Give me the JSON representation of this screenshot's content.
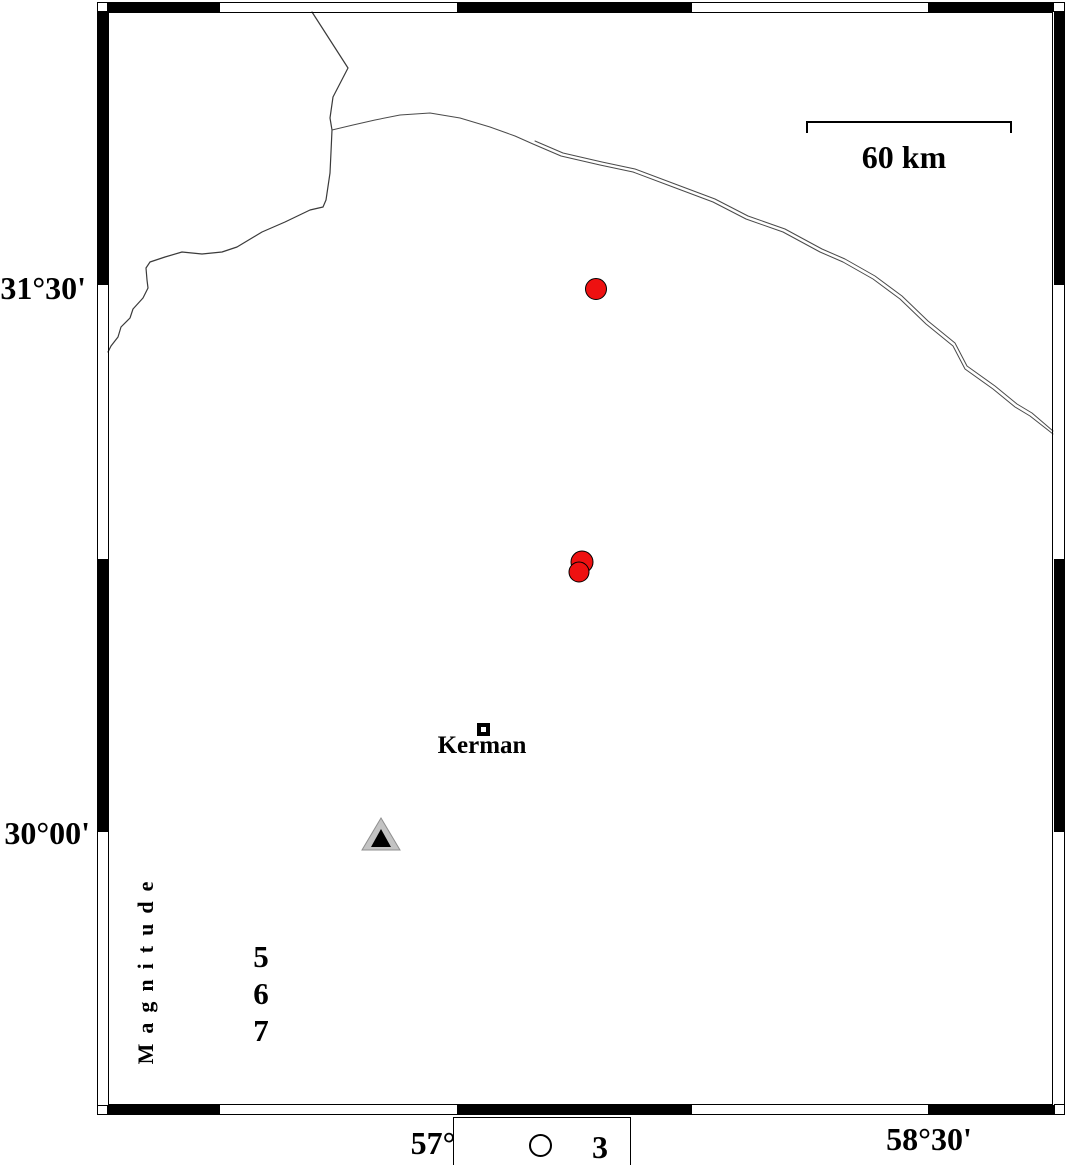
{
  "map": {
    "lat_labels": {
      "upper": "31°30'",
      "lower": "30°00'"
    },
    "lon_labels": {
      "left": "57°",
      "right": "58°30'"
    },
    "scale_bar": {
      "label": "60 km",
      "path": "M 807 133 L 807 122 L 1011 122 L 1011 133"
    },
    "city": {
      "name": "Kerman"
    },
    "magnitude_legend": {
      "title": "Magnitude",
      "values": {
        "v1": "5",
        "v2": "6",
        "v3": "7"
      }
    },
    "symbol_legend": {
      "value": "3"
    },
    "colors": {
      "event_fill": "#ee1111",
      "station_fill": "#c3c3c3",
      "station_core": "#000000",
      "line": "#3a3a3a"
    },
    "events": [
      {
        "cx": 596,
        "cy": 289,
        "r": 10.5
      },
      {
        "cx": 582,
        "cy": 562,
        "r": 11
      },
      {
        "cx": 579,
        "cy": 572,
        "r": 10
      }
    ],
    "shapes": {
      "boundary_line": "312,12 348,68 333,97 330,118 332,130 331,152 330,173 326,200 323,207 310,210 285,222 262,232 237,247 222,252 202,254 182,252 165,257 150,262 146,268 147,280 148,288 143,298 133,309 130,318 121,327 118,337 111,346 108,352",
      "road_line_a": "332,130 353,125 375,120 400,115 430,113 460,118 490,127 515,136 533,144 561,156 600,165 633,172 673,187 713,202 746,219 783,232 820,252 843,262 873,279 900,299 926,324 953,346 965,369 993,389 1015,407 1030,416 1053,434",
      "road_line_b": "535,141 563,153 602,162 635,169 675,184 715,199 748,216 785,229 822,249 845,259 875,276 902,296 928,321 955,343 967,366 995,386 1017,404 1032,413 1053,431",
      "station_outer": "381,818 362,850 400,850",
      "station_inner": "381,829 371,847 391,847"
    },
    "frame": {
      "black_segments": [
        {
          "x": 108,
          "y": 2,
          "w": 112,
          "h": 10
        },
        {
          "x": 457,
          "y": 2,
          "w": 235,
          "h": 10
        },
        {
          "x": 928,
          "y": 2,
          "w": 125,
          "h": 10
        },
        {
          "x": 108,
          "y": 1105,
          "w": 112,
          "h": 10
        },
        {
          "x": 457,
          "y": 1105,
          "w": 235,
          "h": 10
        },
        {
          "x": 928,
          "y": 1105,
          "w": 129,
          "h": 10
        },
        {
          "x": 97,
          "y": 12,
          "w": 11,
          "h": 273
        },
        {
          "x": 97,
          "y": 559,
          "w": 11,
          "h": 273
        },
        {
          "x": 1054,
          "y": 10,
          "w": 11,
          "h": 275
        },
        {
          "x": 1054,
          "y": 559,
          "w": 11,
          "h": 273
        }
      ]
    }
  }
}
